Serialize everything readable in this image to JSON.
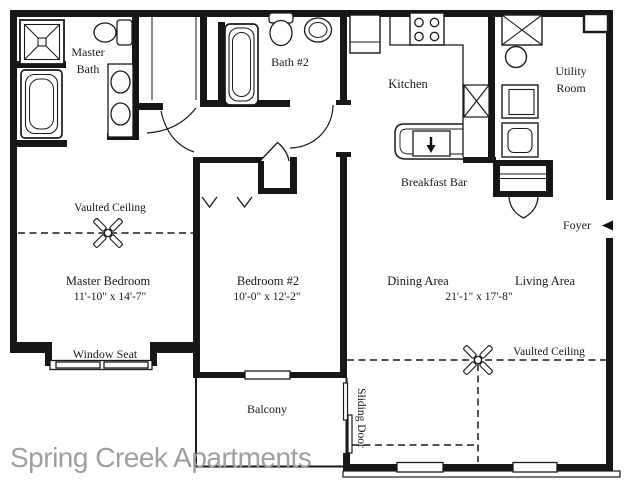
{
  "watermark": "Spring Creek Apartments",
  "labels": {
    "master_bath_line1": "Master",
    "master_bath_line2": "Bath",
    "bath2": "Bath #2",
    "kitchen": "Kitchen",
    "utility_line1": "Utility",
    "utility_line2": "Room",
    "breakfast_bar": "Breakfast Bar",
    "foyer": "Foyer",
    "master_vaulted_ceiling": "Vaulted Ceiling",
    "master_bedroom": "Master Bedroom",
    "master_bedroom_dims": "11'-10\" x 14'-7\"",
    "bedroom2": "Bedroom #2",
    "bedroom2_dims": "10'-0\" x 12'-2\"",
    "dining": "Dining Area",
    "living": "Living Area",
    "living_dims": "21'-1\" x 17'-8\"",
    "living_vaulted_ceiling": "Vaulted Ceiling",
    "window_seat": "Window Seat",
    "balcony": "Balcony",
    "sliding_door": "Sliding Door"
  },
  "colors": {
    "wall": "#161616",
    "text": "#1a1a1a",
    "watermark": "#9f9f9f",
    "background": "#ffffff"
  }
}
